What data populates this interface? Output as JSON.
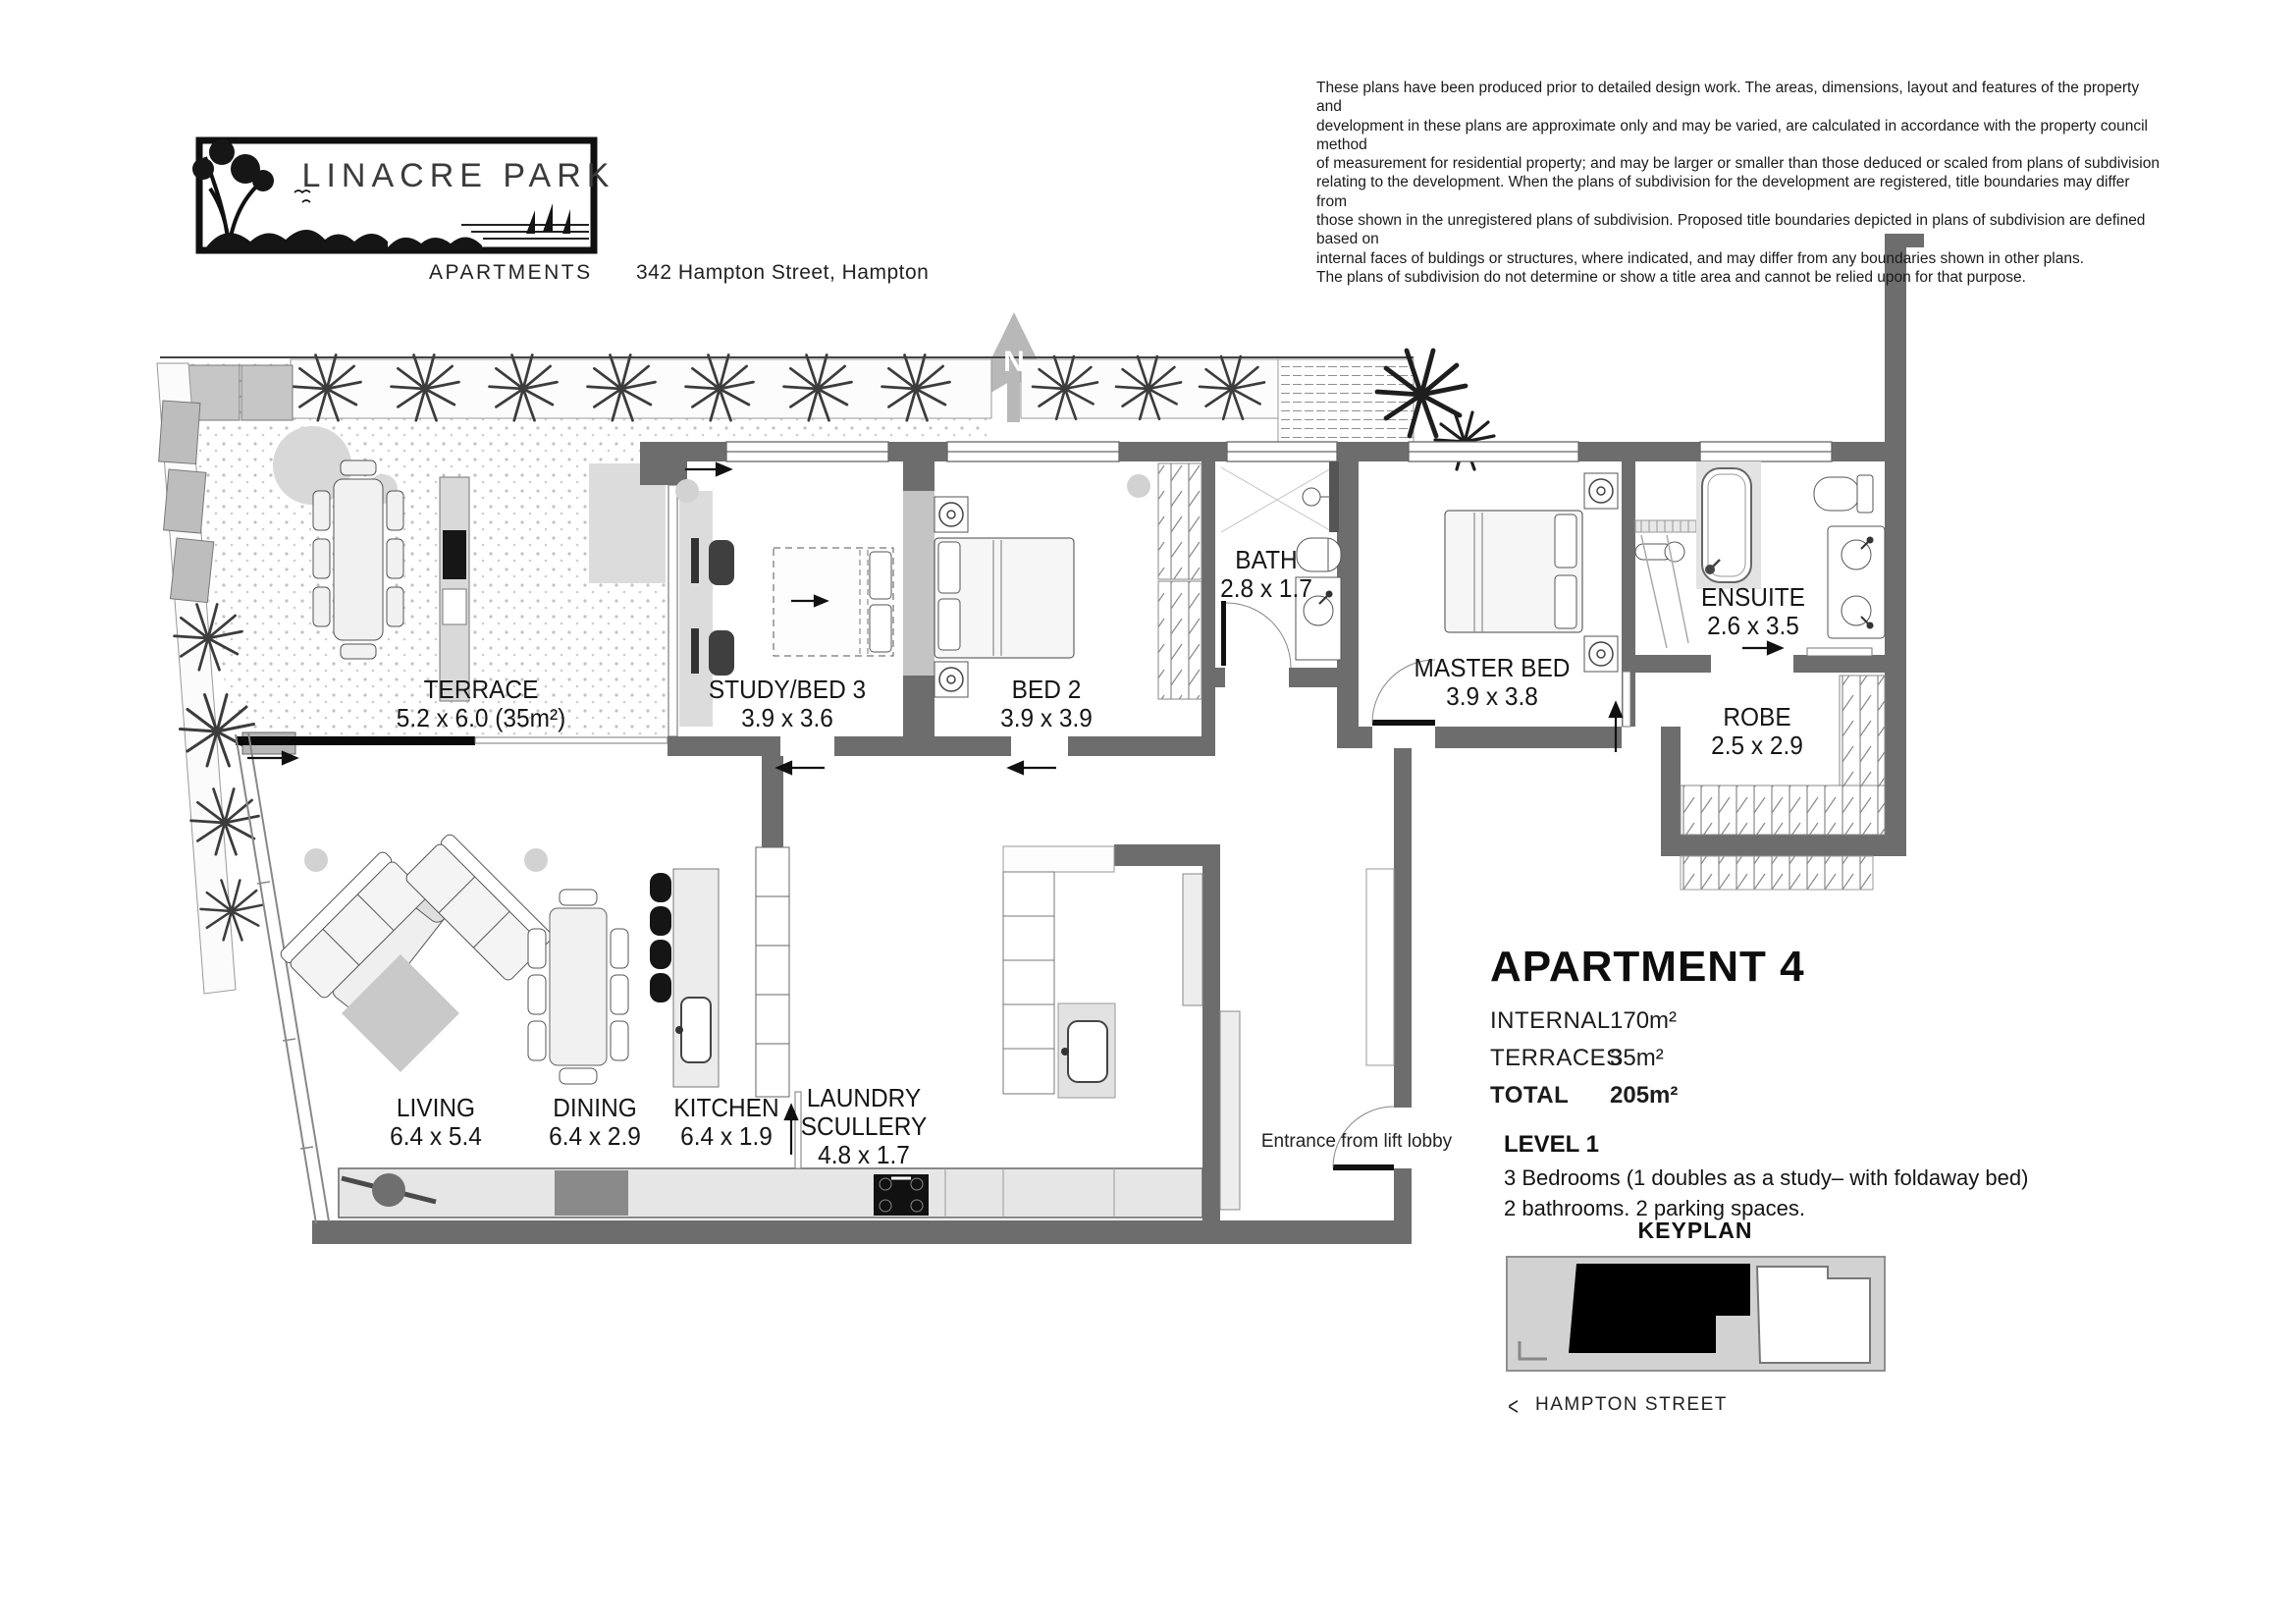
{
  "header": {
    "logo_title": "LINACRE PARK",
    "brand": "APARTMENTS",
    "address": "342 Hampton Street, Hampton",
    "disclaimer_lines": [
      "These plans have been produced prior to detailed design work. The areas, dimensions, layout and features of the property and",
      "development in these plans are approximate only and may be varied, are calculated in accordance with the property council method",
      "of measurement for residential property; and may be larger or smaller than those deduced or scaled from plans of subdivision",
      "relating to the development. When the plans of subdivision for the development are registered, title boundaries may differ from",
      "those shown in the unregistered plans of subdivision. Proposed title boundaries depicted in plans of subdivision are defined based on",
      "internal faces of buldings or structures, where indicated, and may differ from any boundaries shown in other plans.",
      "The plans of subdivision do not determine or show a title area and cannot be relied upon for that purpose."
    ]
  },
  "north": {
    "label": "N"
  },
  "rooms": {
    "terrace": {
      "name": "TERRACE",
      "dims": "5.2 x 6.0 (35m²)"
    },
    "study": {
      "name": "STUDY/BED 3",
      "dims": "3.9 x 3.6"
    },
    "bed2": {
      "name": "BED 2",
      "dims": "3.9 x 3.9"
    },
    "bath": {
      "name": "BATH",
      "dims": "2.8 x 1.7"
    },
    "master": {
      "name": "MASTER BED",
      "dims": "3.9 x 3.8"
    },
    "ensuite": {
      "name": "ENSUITE",
      "dims": "2.6 x 3.5"
    },
    "robe": {
      "name": "ROBE",
      "dims": "2.5 x 2.9"
    },
    "living": {
      "name": "LIVING",
      "dims": "6.4 x 5.4"
    },
    "dining": {
      "name": "DINING",
      "dims": "6.4 x 2.9"
    },
    "kitchen": {
      "name": "KITCHEN",
      "dims": "6.4 x 1.9"
    },
    "laundry": {
      "name": "LAUNDRY",
      "name2": "SCULLERY",
      "dims": "4.8 x 1.7"
    }
  },
  "plan": {
    "entrance_note": "Entrance from lift lobby"
  },
  "info": {
    "title": "APARTMENT 4",
    "internal_label": "INTERNAL",
    "internal_value": "170m²",
    "terraces_label": "TERRACES",
    "terraces_value": "35m²",
    "total_label": "TOTAL",
    "total_value": "205m²",
    "level": "LEVEL 1",
    "line1": "3 Bedrooms (1 doubles as a study– with foldaway bed)",
    "line2": "2 bathrooms. 2 parking spaces."
  },
  "keyplan": {
    "title": "KEYPLAN",
    "street": "HAMPTON STREET",
    "chevron": "<"
  }
}
